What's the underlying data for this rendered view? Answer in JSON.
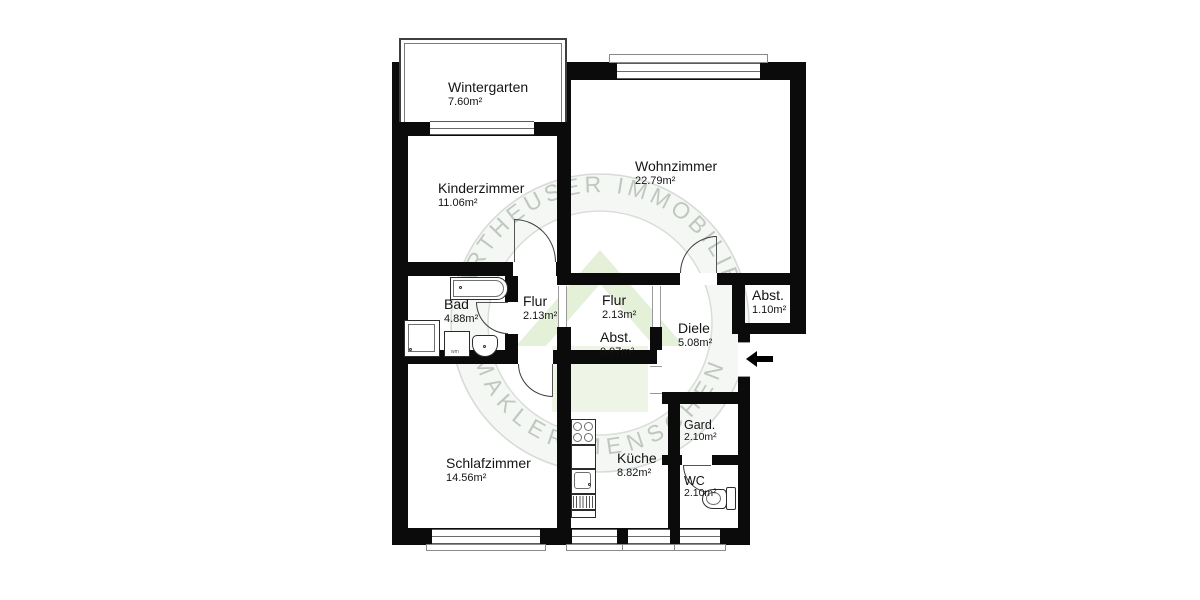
{
  "watermark": {
    "arc_top": "KARTHEUSER IMMOBILIEN",
    "arc_bottom": "MAKLER.MENSCHEN"
  },
  "rooms": {
    "wintergarten": {
      "name": "Wintergarten",
      "area": "7.60m²"
    },
    "kinderzimmer": {
      "name": "Kinderzimmer",
      "area": "11.06m²"
    },
    "wohnzimmer": {
      "name": "Wohnzimmer",
      "area": "22.79m²"
    },
    "bad": {
      "name": "Bad",
      "area": "4.88m²"
    },
    "flur_links": {
      "name": "Flur",
      "area": "2.13m²"
    },
    "flur_rechts": {
      "name": "Flur",
      "area": "2.13m²"
    },
    "abst_klein": {
      "name": "Abst.",
      "area": "0.97m²"
    },
    "diele": {
      "name": "Diele",
      "area": "5.08m²"
    },
    "abst_eingang": {
      "name": "Abst.",
      "area": "1.10m²"
    },
    "schlafzimmer": {
      "name": "Schlafzimmer",
      "area": "14.56m²"
    },
    "kueche": {
      "name": "Küche",
      "area": "8.82m²"
    },
    "gard": {
      "name": "Gard.",
      "area": "2.10m²"
    },
    "wc": {
      "name": "WC",
      "area": "2.10m²"
    }
  },
  "fixtures": {
    "washing_machine_label": "wm"
  },
  "colors": {
    "wall": "#0b0b0b",
    "door_line": "#3a3a3a",
    "window_line": "#6a6a6a",
    "logo_green": "#7cb342",
    "watermark_text": "#93a393"
  }
}
